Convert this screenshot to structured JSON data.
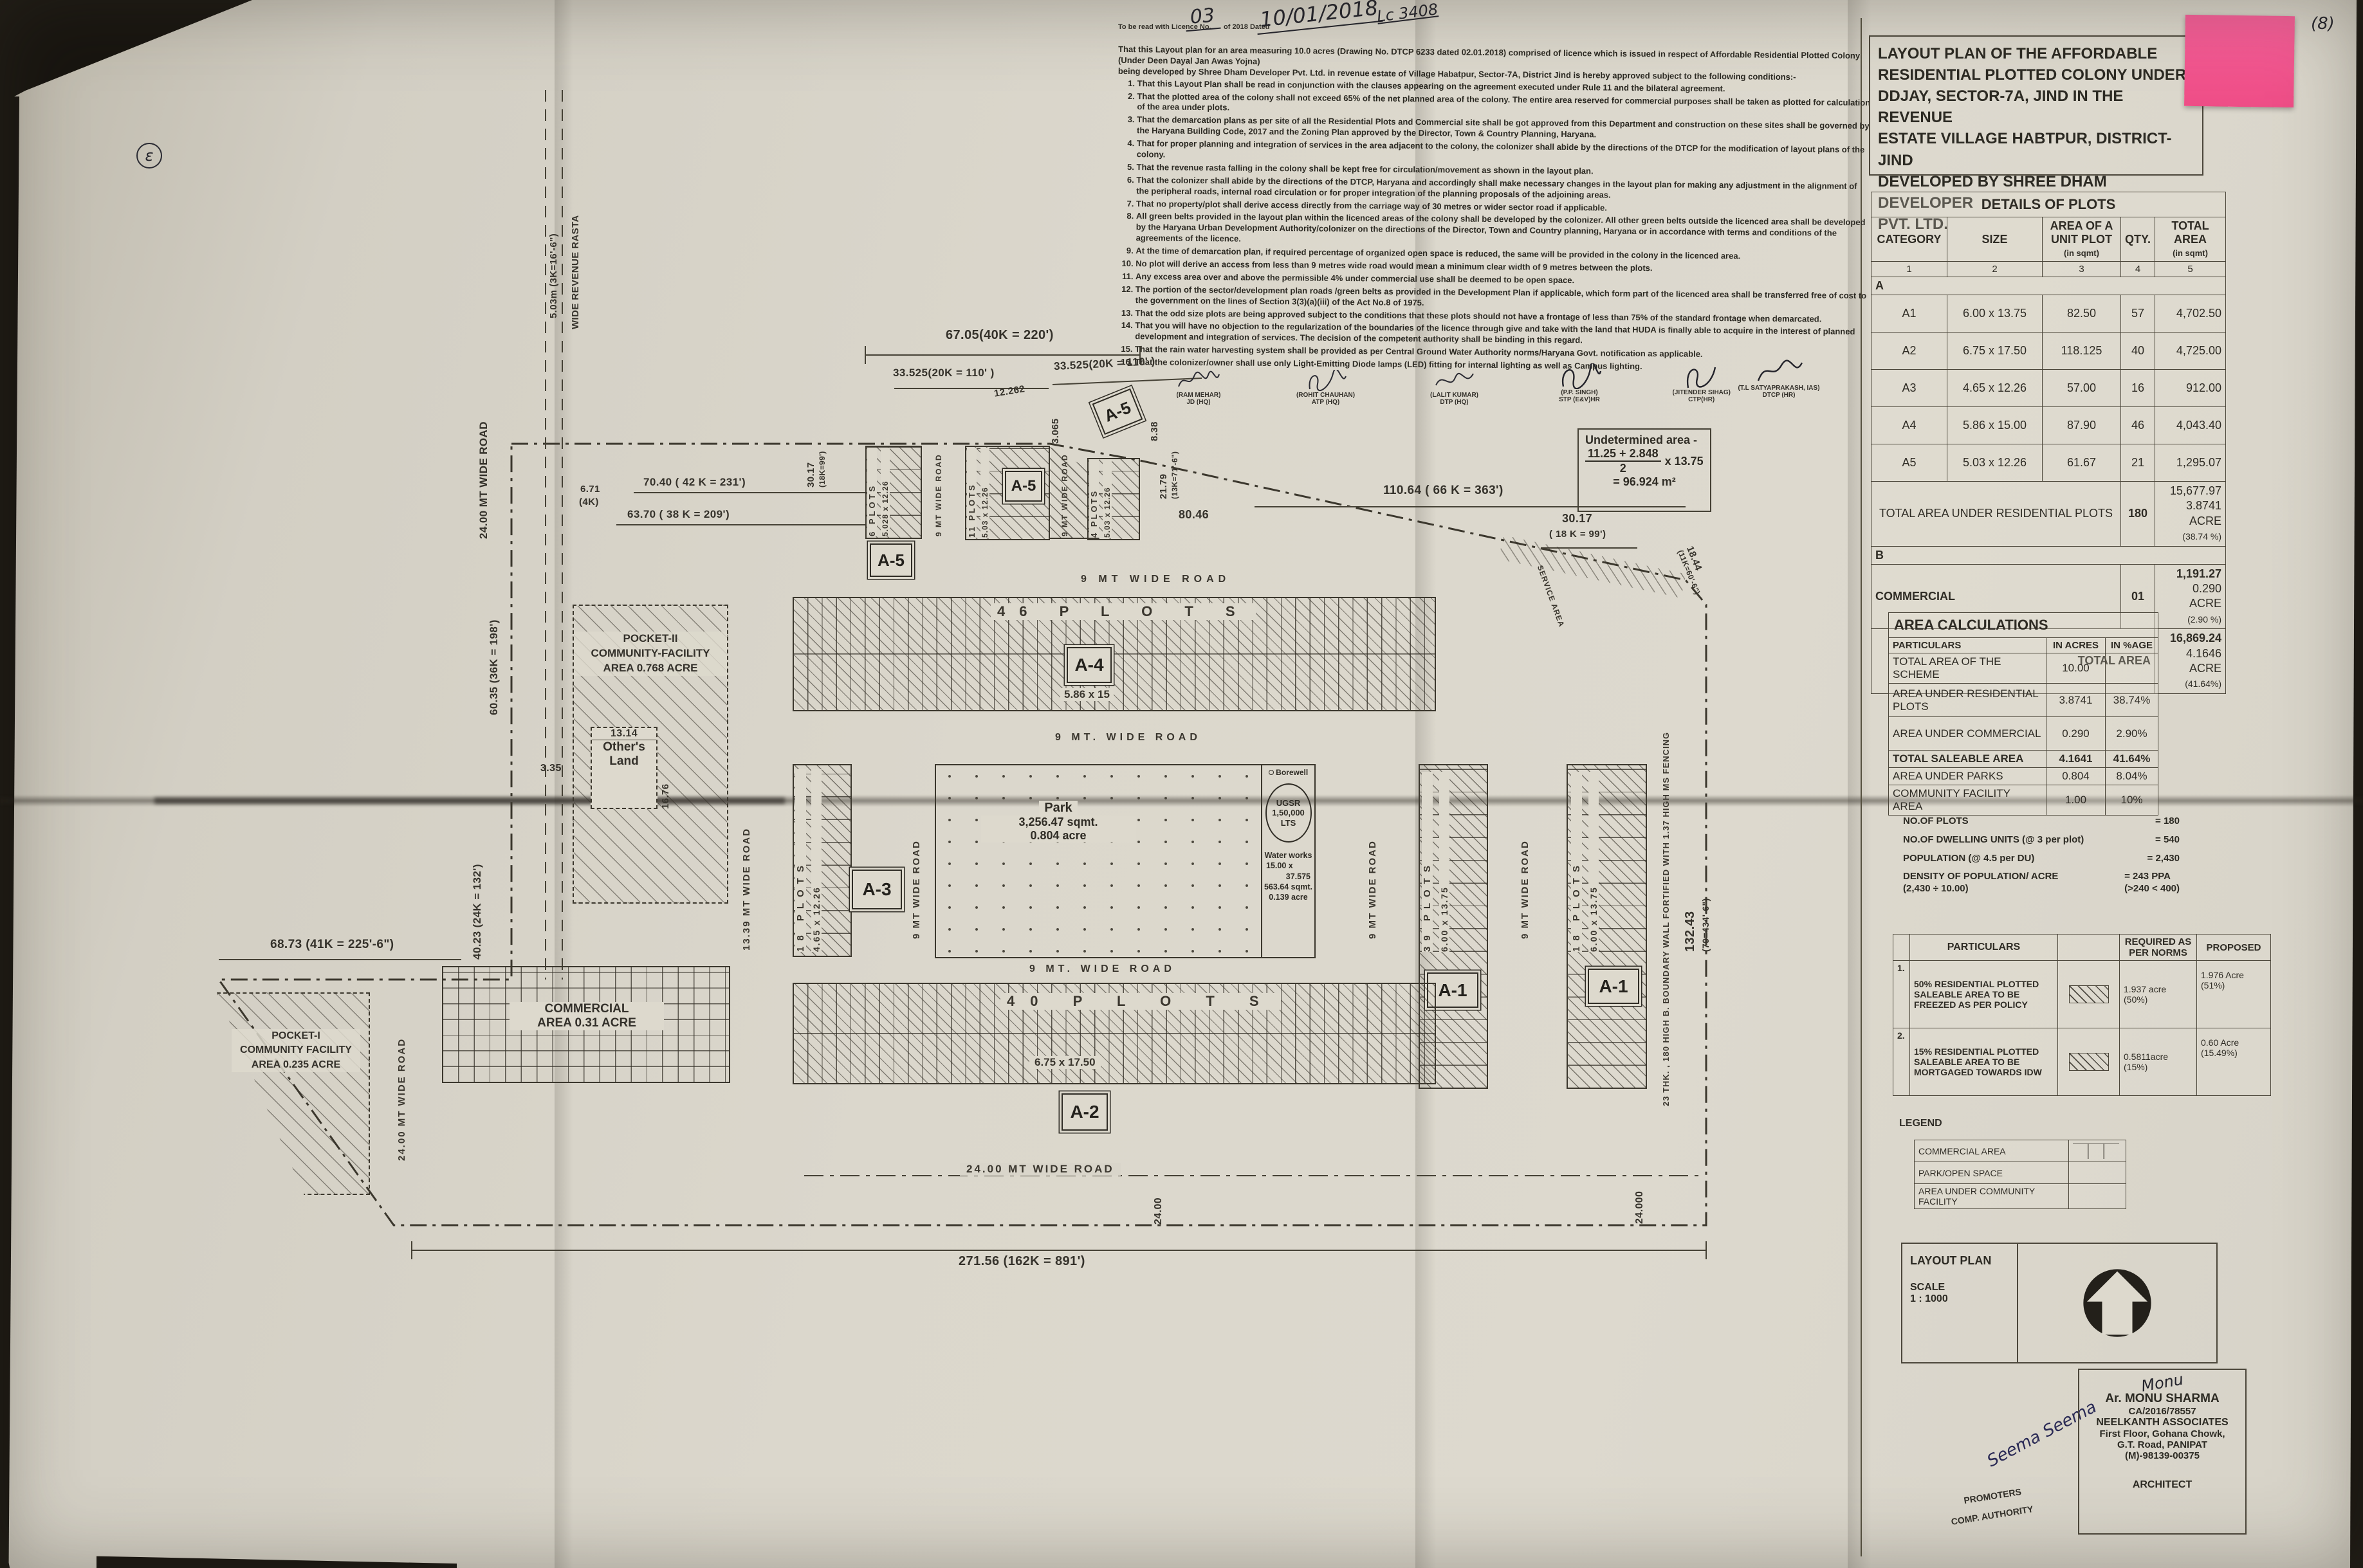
{
  "colors": {
    "paper": "#dbd7cc",
    "ink": "#33302a",
    "sticky": "#f2548e"
  },
  "annotations": {
    "page_num": "(8)",
    "lc_ref": "Lc 3408",
    "licence_prefix": "To be read with Licence No.",
    "licence_no": "03",
    "licence_of": "of 2018  Dated",
    "licence_date": "10/01/2018",
    "corner_mark": "ɛ"
  },
  "notes": {
    "intro1": "That this Layout plan for an area measuring 10.0 acres (Drawing No. DTCP  6233 dated 02.01.2018) comprised of licence which is issued in respect of Affordable Residential Plotted Colony (Under Deen Dayal Jan Awas Yojna)",
    "intro2": "being developed by Shree Dham  Developer Pvt. Ltd. in revenue estate of Village Habatpur, Sector-7A, District Jind is hereby approved subject to the following conditions:-",
    "items": [
      "That this Layout Plan shall be read in conjunction with the clauses appearing on the agreement executed under Rule 11 and the bilateral agreement.",
      "That the plotted area of the colony shall not exceed 65% of the net planned area of the colony. The entire area reserved for commercial purposes shall be taken as plotted for calculation of the area under plots.",
      "That the demarcation plans as per site of all the Residential Plots and Commercial site shall be got approved from this Department and construction on these sites shall be governed by the Haryana Building Code, 2017 and the Zoning Plan approved by the Director, Town & Country Planning, Haryana.",
      "That for proper planning and integration of services in the area adjacent to the colony, the colonizer shall abide by the directions of the DTCP for the modification of layout plans of the colony.",
      "That the revenue rasta falling in the colony shall be kept free for circulation/movement as shown in the layout plan.",
      "That the colonizer shall abide by the directions of the DTCP, Haryana and accordingly shall make necessary changes in the layout plan for making any adjustment in the alignment of the peripheral roads, internal road circulation or for proper integration of the planning proposals of the adjoining areas.",
      "That no property/plot shall derive access directly from the carriage way of 30 metres or wider sector road if applicable.",
      "All green belts provided in the layout plan within the licenced areas of the colony shall be developed by the colonizer. All other green belts outside the licenced area shall be developed by the Haryana Urban Development Authority/colonizer on the directions of the Director, Town and Country planning, Haryana or in accordance with terms and conditions of the agreements of the licence.",
      "At the time of demarcation plan, if required percentage of organized open space is reduced, the same will be provided in the colony in the licenced area.",
      "No plot will derive an access from less than 9 metres wide road would mean a minimum clear width of 9 metres between the plots.",
      "Any excess area over and above the permissible 4% under commercial use shall be deemed to be open space.",
      "The portion of the sector/development plan roads /green belts as provided in the Development Plan if applicable, which form part of the licenced area shall be transferred free of cost to the government on the lines of Section 3(3)(a)(iii) of the Act No.8 of 1975.",
      "That the odd size plots are being approved subject to the conditions that these plots should not have a frontage of less than 75% of the standard frontage when demarcated.",
      "That you will have no objection to the regularization of the boundaries of the licence through give and take with the land that HUDA is finally able to acquire in the interest of planned development and integration of services. The decision of the competent authority shall be binding in this regard.",
      "That the rain water harvesting system shall be provided as per Central Ground Water Authority norms/Haryana Govt. notification as applicable.",
      "That the colonizer/owner shall use only Light-Emitting Diode lamps (LED) fitting for internal lighting as well as Campus lighting.",
      "That the colonizer/owner shall ensure the installation of Solar Power Plant as per provisions of Haryana Solar Power Policy, 2016 issued by Haryana Government Renewable Energy Department vide Notification No. 19/4/2016-5 Power dated 14.03.2016.",
      "That the colonizer/owner shall ensure the installation of Solar Photovoltaic Power Plant as per the provisions of order No.22/52/2005-5Power dated 21.03.2016 issued by Haryana Government Renewable Energy Department.",
      "That the colonizer/owner shall strictly comply with the directions issued vide Notification No. 19/6/2016-5P dated 31.03.2016 issued by Haryana Government Renewable Energy Department for enforcement of the Energy Conservation Building Codes."
    ]
  },
  "signatories": [
    {
      "name": "(RAM MEHAR)",
      "title": "JD (HQ)"
    },
    {
      "name": "(ROHIT CHAUHAN)",
      "title": "ATP (HQ)"
    },
    {
      "name": "(LALIT KUMAR)",
      "title": "DTP (HQ)"
    },
    {
      "name": "(P.P. SINGH)",
      "title": "STP (E&V)HR"
    },
    {
      "name": "(JITENDER SIHAG)",
      "title": "CTP(HR)"
    },
    {
      "name": "(T.L SATYAPRAKASH, IAS)",
      "title": "DTCP (HR)"
    }
  ],
  "undetermined": {
    "l1": "Undetermined area -",
    "num": "11.25 + 2.848",
    "den": "2",
    "mult": "x 13.75",
    "res": "= 96.924 m²"
  },
  "title_block": {
    "l1": "LAYOUT PLAN OF THE AFFORDABLE",
    "l2": "RESIDENTIAL PLOTTED COLONY UNDER",
    "l3": "DDJAY, SECTOR-7A, JIND IN THE REVENUE",
    "l4": "ESTATE VILLAGE HABTPUR, DISTRICT- JIND",
    "l5": "DEVELOPED BY SHREE DHAM DEVELOPER",
    "l6": "PVT. LTD."
  },
  "details": {
    "title": "DETAILS OF PLOTS",
    "h1": "CATEGORY",
    "h2": "SIZE",
    "h3": "AREA OF A UNIT PLOT",
    "h3sub": "(in sqmt)",
    "h4": "QTY.",
    "h5": "TOTAL AREA",
    "h5sub": "(in sqmt)",
    "n1": "1",
    "n2": "2",
    "n3": "3",
    "n4": "4",
    "n5": "5",
    "groupA": "A",
    "rows": [
      {
        "c": "A1",
        "s": "6.00 x 13.75",
        "a": "82.50",
        "q": "57",
        "t": "4,702.50"
      },
      {
        "c": "A2",
        "s": "6.75 x 17.50",
        "a": "118.125",
        "q": "40",
        "t": "4,725.00"
      },
      {
        "c": "A3",
        "s": "4.65 x 12.26",
        "a": "57.00",
        "q": "16",
        "t": "912.00"
      },
      {
        "c": "A4",
        "s": "5.86 x 15.00",
        "a": "87.90",
        "q": "46",
        "t": "4,043.40"
      },
      {
        "c": "A5",
        "s": "5.03 x 12.26",
        "a": "61.67",
        "q": "21",
        "t": "1,295.07"
      }
    ],
    "tr_label": "TOTAL AREA UNDER RESIDENTIAL PLOTS",
    "tr_qty": "180",
    "tr_a1": "15,677.97",
    "tr_a2": "3.8741 ACRE",
    "tr_a3": "(38.74 %)",
    "groupB": "B",
    "com_label": "COMMERCIAL",
    "com_qty": "01",
    "com_a1": "1,191.27",
    "com_a2": "0.290 ACRE",
    "com_a3": "(2.90 %)",
    "tot_label": "TOTAL AREA",
    "tot_a1": "16,869.24",
    "tot_a2": "4.1646 ACRE",
    "tot_a3": "(41.64%)"
  },
  "area_calc": {
    "title": "AREA CALCULATIONS",
    "h1": "PARTICULARS",
    "h2": "IN ACRES",
    "h3": "IN %AGE",
    "rows": [
      {
        "p": "TOTAL AREA OF THE SCHEME",
        "a": "10.00",
        "pc": ""
      },
      {
        "p": "AREA UNDER RESIDENTIAL PLOTS",
        "a": "3.8741",
        "pc": "38.74%"
      },
      {
        "p": "AREA UNDER COMMERCIAL",
        "a": "0.290",
        "pc": "2.90%"
      },
      {
        "p": "TOTAL SALEABLE AREA",
        "a": "4.1641",
        "pc": "41.64%"
      },
      {
        "p": "AREA UNDER PARKS",
        "a": "0.804",
        "pc": "8.04%"
      },
      {
        "p": "COMMUNITY FACILITY AREA",
        "a": "1.00",
        "pc": "10%"
      }
    ]
  },
  "stats": [
    {
      "l": "NO.OF PLOTS",
      "l2": "",
      "v": "= 180",
      "v2": ""
    },
    {
      "l": "NO.OF DWELLING UNITS (@ 3 per plot)",
      "l2": "",
      "v": "= 540",
      "v2": ""
    },
    {
      "l": "POPULATION (@ 4.5 per DU)",
      "l2": "",
      "v": "= 2,430",
      "v2": ""
    },
    {
      "l": "DENSITY OF POPULATION/ ACRE",
      "l2": "(2,430 ÷ 10.00)",
      "v": "= 243 PPA",
      "v2": "(>240 < 400)"
    }
  ],
  "norms": {
    "h1": "PARTICULARS",
    "h2": "REQUIRED AS PER NORMS",
    "h3": "PROPOSED",
    "rows": [
      {
        "n": "1.",
        "p": "50% RESIDENTIAL PLOTTED SALEABLE AREA TO BE FREEZED AS PER POLICY",
        "r": "1.937 acre",
        "r2": "(50%)",
        "pr": "1.976 Acre",
        "pr2": "(51%)"
      },
      {
        "n": "2.",
        "p": "15% RESIDENTIAL PLOTTED SALEABLE AREA TO BE MORTGAGED TOWARDS IDW",
        "r": "0.5811acre",
        "r2": "(15%)",
        "pr": "0.60 Acre",
        "pr2": "(15.49%)"
      }
    ]
  },
  "legend": {
    "title": "LEGEND",
    "items": [
      "COMMERCIAL AREA",
      "PARK/OPEN SPACE",
      "AREA UNDER COMMUNITY FACILITY"
    ]
  },
  "scale_block": {
    "t": "LAYOUT PLAN",
    "s": "SCALE",
    "v": "1 : 1000"
  },
  "sign_block": {
    "sig": "Monu",
    "name": "Ar. MONU SHARMA",
    "reg": "CA/2016/78557",
    "firm": "NEELKANTH ASSOCIATES",
    "a1": "First Floor, Gohana Chowk,",
    "a2": "G.T. Road, PANIPAT",
    "ph": "(M)-98139-00375",
    "role": "ARCHITECT",
    "lsig": "Seema  Seema",
    "lrole1": "PROMOTERS",
    "lrole2": "COMP. AUTHORITY"
  },
  "plan": {
    "dims": {
      "d67": "67.05(40K = 220')",
      "d33a": "33.525(20K = 110' )",
      "d33b": "33.525(20K = 110' )",
      "d12262": "12.262",
      "d3065": "3.065",
      "d7040": "70.40 ( 42 K = 231')",
      "d6370": "63.70 ( 38 K = 209')",
      "d671": "6.71",
      "d671b": "(4K)",
      "d3017a": "30.17",
      "d3017a2": "(18K=99')",
      "d838": "8.38",
      "d2179": "21.79",
      "d2179b": "(13K=71'-6\")",
      "d11064": "110.64 ( 66 K = 363')",
      "d8046": "80.46",
      "d3017b": "30.17",
      "d3017b2": "( 18 K = 99')",
      "d1844": "18.44",
      "d1844b": "(11K=60'-6\")",
      "d6035": "60.35 (36K = 198')",
      "d4023": "40.23 (24K = 132')",
      "d6873": "68.73  (41K = 225'-6\")",
      "d13243": "132.43",
      "d13243b": "(79=434'-6\")",
      "d27156": "271.56 (162K = 891')",
      "d24a": "24.00",
      "d24b": "24.000",
      "d1314": "13.14",
      "d335": "3.35",
      "d1676": "16.76"
    },
    "roads": {
      "r24l": "24.00 MT WIDE ROAD",
      "rasta1": "5.03m (3K=16'-6\")",
      "rasta2": "WIDE REVENUE RASTA",
      "r9v1": "9 MT WIDE ROAD",
      "r9v2": "9 MT WIDE ROAD",
      "r9h1": "9 MT WIDE ROAD",
      "r9h2": "9 MT. WIDE ROAD",
      "r9h3": "9 MT. WIDE ROAD",
      "r1339": "13.39 MT WIDE ROAD",
      "r9v3": "9 MT WIDE ROAD",
      "r9v4": "9 MT WIDE ROAD",
      "r9v5": "9 MT WIDE ROAD",
      "r24b": "24.00 MT  WIDE  ROAD",
      "r24l2": "24.00 MT WIDE ROAD"
    },
    "blocks": {
      "a5": "A-5",
      "a4": "A-4",
      "a3": "A-3",
      "a2": "A-2",
      "a1": "A-1",
      "col1n": "6 PLOTS",
      "col1s": "5.028 x 12.26",
      "col2n": "11 PLOTS",
      "col2s": "5.03 x 12.26",
      "col3n": "4 PLOTS",
      "col3s": "5.03 x 12.26",
      "row46": "46   P L O T S",
      "a4s": "5.86  x  15",
      "col18a": "18 PLOTS",
      "col18as": "4.65 x 12.26",
      "col39": "39 PLOTS",
      "col39s": "6.00 x 13.75",
      "col18b": "18 PLOTS",
      "col18bs": "6.00 x 13.75",
      "row40": "40    P L O T S",
      "a2s": "6.75   x  17.50",
      "park1": "Park",
      "park2": "3,256.47 sqmt.",
      "park3": "0.804 acre",
      "borewell": "Borewell",
      "ugsr1": "UGSR",
      "ugsr2": "1,50,000",
      "ugsr3": "LTS",
      "ww1": "Water works",
      "ww2": "15.00 x",
      "ww3": "37.575",
      "ww4": "563.64 sqmt.",
      "ww5": "0.139 acre",
      "pocket2a": "POCKET-II",
      "pocket2b": "COMMUNITY-FACILITY",
      "pocket2c": "AREA 0.768 ACRE",
      "pocket1a": "POCKET-I",
      "pocket1b": "COMMUNITY FACILITY",
      "pocket1c": "AREA 0.235 ACRE",
      "comm1": "COMMERCIAL",
      "comm2": "AREA 0.31 ACRE",
      "others1": "Other's",
      "others2": "Land",
      "service": "SERVICE AREA",
      "wall": "23 THK. , 180 HIGH B. BOUNDARY WALL FORTIFIED WITH 1.37 HIGH MS FENCING"
    }
  }
}
